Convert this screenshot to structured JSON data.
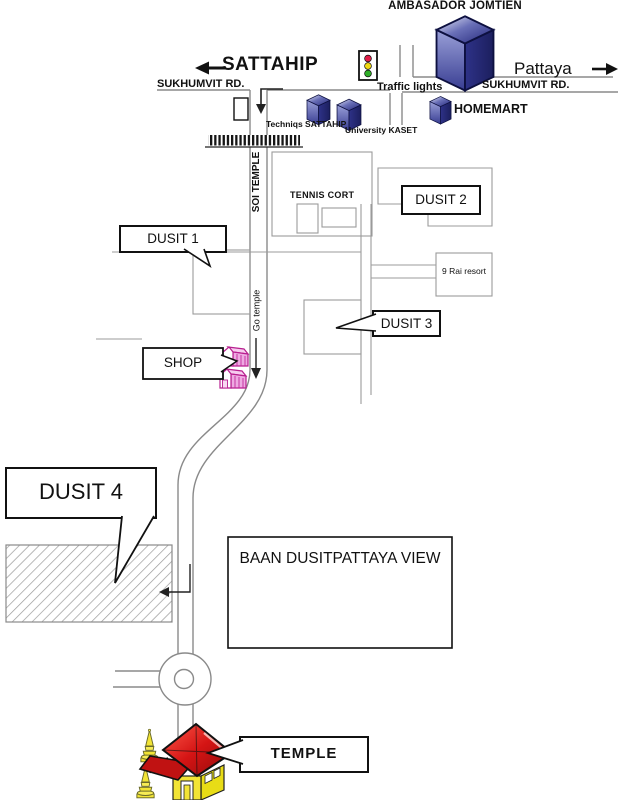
{
  "map": {
    "title": "AMBASADOR JOMTIEN",
    "directions": {
      "west": "SATTAHIP",
      "east": "Pattaya"
    },
    "roads": {
      "sukhumvit_left": "SUKHUMVIT RD.",
      "sukhumvit_right": "SUKHUMVIT RD.",
      "soi": "SOI TEMPLE",
      "go_temple": "Go temple"
    },
    "landmarks": {
      "traffic_lights": "Traffic lights",
      "techniqs": "Techniqs SATTAHIP",
      "university": "University KASET",
      "homemart": "HOMEMART",
      "tennis_court": "TENNIS CORT",
      "dusit1": "DUSIT 1",
      "dusit2": "DUSIT 2",
      "dusit3": "DUSIT 3",
      "dusit4": "DUSIT 4",
      "nine_rai": "9 Rai resort",
      "shop": "SHOP",
      "baan": "BAAN DUSITPATTAYA VIEW",
      "temple": "TEMPLE"
    },
    "icons": [
      "building-cube-icon",
      "traffic-light-icon",
      "railroad-crossing-icon",
      "shop-house-icon",
      "pagoda-icon",
      "temple-building-icon",
      "roundabout-icon",
      "arrow-west-icon",
      "arrow-east-icon",
      "turn-into-soi-arrow-icon",
      "go-down-arrow-icon",
      "enter-dusit4-arrow-icon"
    ],
    "colors": {
      "building_navy": "#23267a",
      "building_navy_light": "#8b90cc",
      "road_gray": "#8a8a8a",
      "block_gray": "#9b9b9b",
      "traffic_red": "#e11d48",
      "traffic_yellow": "#f2d912",
      "traffic_green": "#2fae27",
      "shop_pink": "#eeaae2",
      "shop_outline": "#b81f8f",
      "temple_red": "#d41414",
      "temple_yellow": "#f2e435",
      "ink": "#111111"
    }
  }
}
